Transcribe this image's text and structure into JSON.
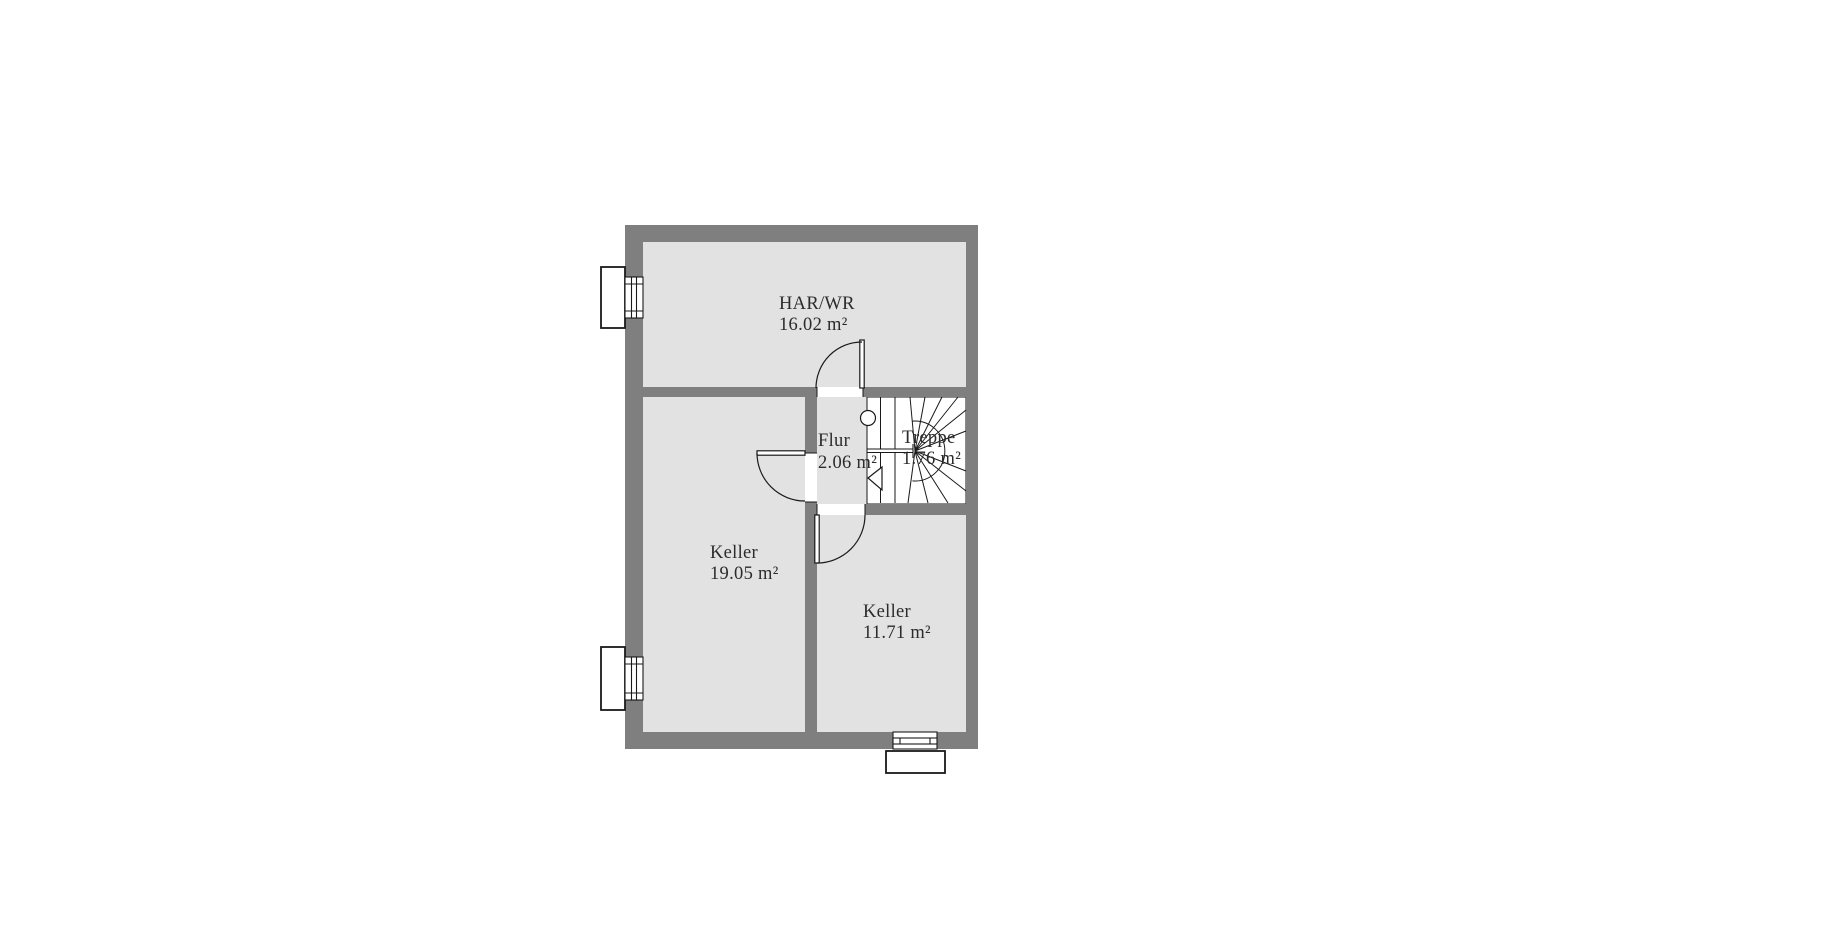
{
  "plan": {
    "rooms": [
      {
        "name": "HAR/WR",
        "area": "16.02 m²"
      },
      {
        "name": "Keller",
        "area": "19.05 m²"
      },
      {
        "name": "Flur",
        "area": "2.06 m²"
      },
      {
        "name": "Treppe",
        "area": "1.76 m²"
      },
      {
        "name": "Keller",
        "area": "11.71 m²"
      }
    ]
  },
  "colors": {
    "wall": "#7f7f7f",
    "room": "#e2e2e2",
    "line": "#1a1a1a",
    "text": "#2b2b2b",
    "bg": "#ffffff"
  }
}
